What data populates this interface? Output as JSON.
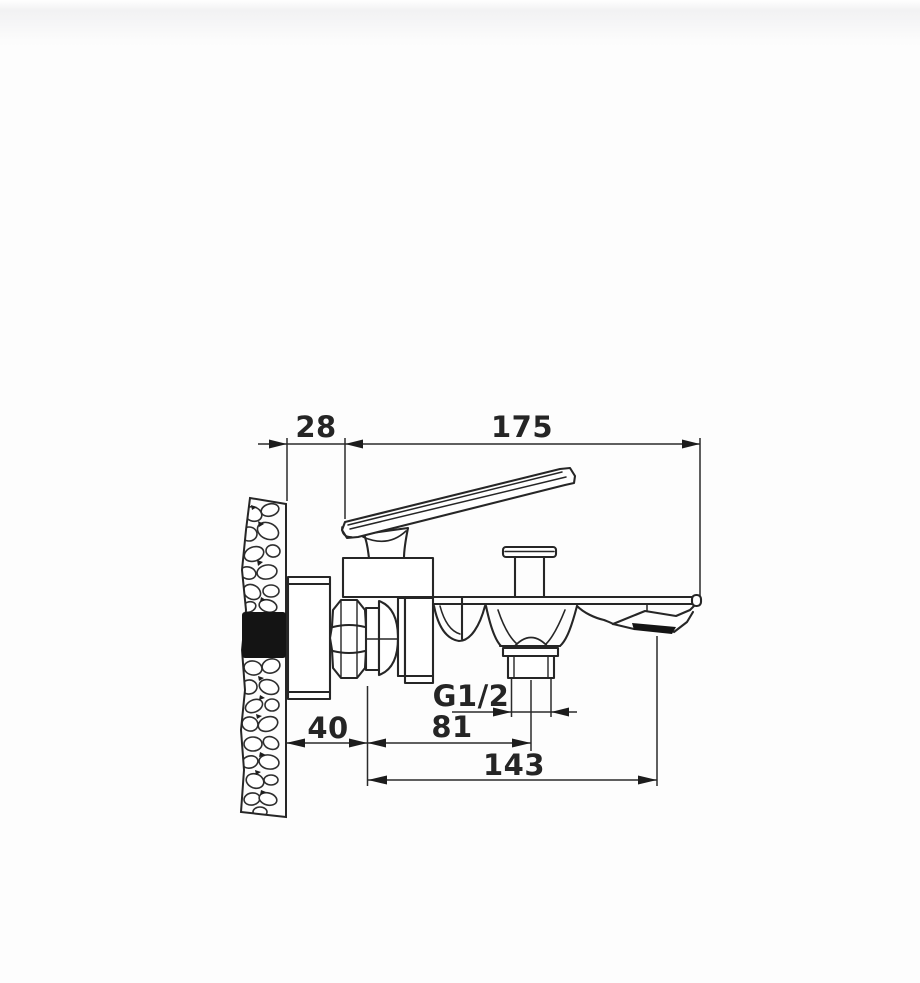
{
  "drawing": {
    "title": "Wall-mounted bath mixer faucet — side installation drawing",
    "labels": {
      "dim_wall_offset": "28",
      "dim_total_length": "175",
      "dim_thread": "G1/2",
      "dim_wall_to_axis": "40",
      "dim_axis_to_outlet": "81",
      "dim_axis_to_tip": "143"
    },
    "colors": {
      "line": "#262626",
      "dim_line": "#2b2b2b",
      "solid_fill": "#141414",
      "background": "#fdfdfd"
    }
  }
}
